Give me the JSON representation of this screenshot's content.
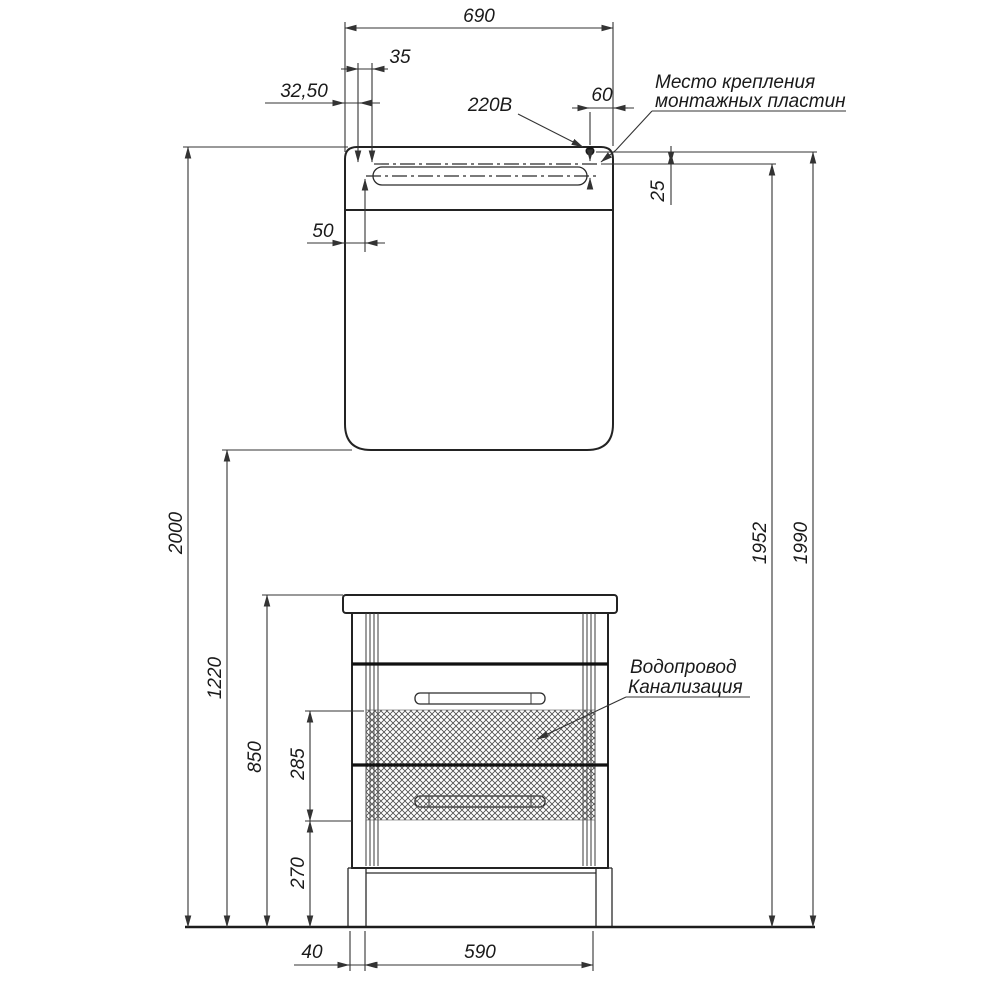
{
  "drawing": {
    "kind": "furniture-installation-drawing",
    "colors": {
      "line": "#232323",
      "background": "#ffffff",
      "hatch": "#4d4d4d"
    },
    "dims": {
      "mirror_width": "690",
      "plate_spacing": "35",
      "plate_offset_left": "32,50",
      "power_label": "220В",
      "plate_offset_right": "60",
      "plate_below_top": "25",
      "lamp_inset": "50",
      "total_height": "2000",
      "mirror_bottom_height": "1220",
      "vanity_height": "850",
      "utility_zone_height": "285",
      "utility_zone_bottom": "270",
      "plate_mount_height": "1952",
      "mirror_top_height": "1990",
      "leg_inset": "40",
      "cabinet_width": "590"
    },
    "notes": {
      "mounting_line1": "Место крепления",
      "mounting_line2": "монтажных пластин",
      "utility_line1": "Водопровод",
      "utility_line2": "Канализация"
    }
  }
}
